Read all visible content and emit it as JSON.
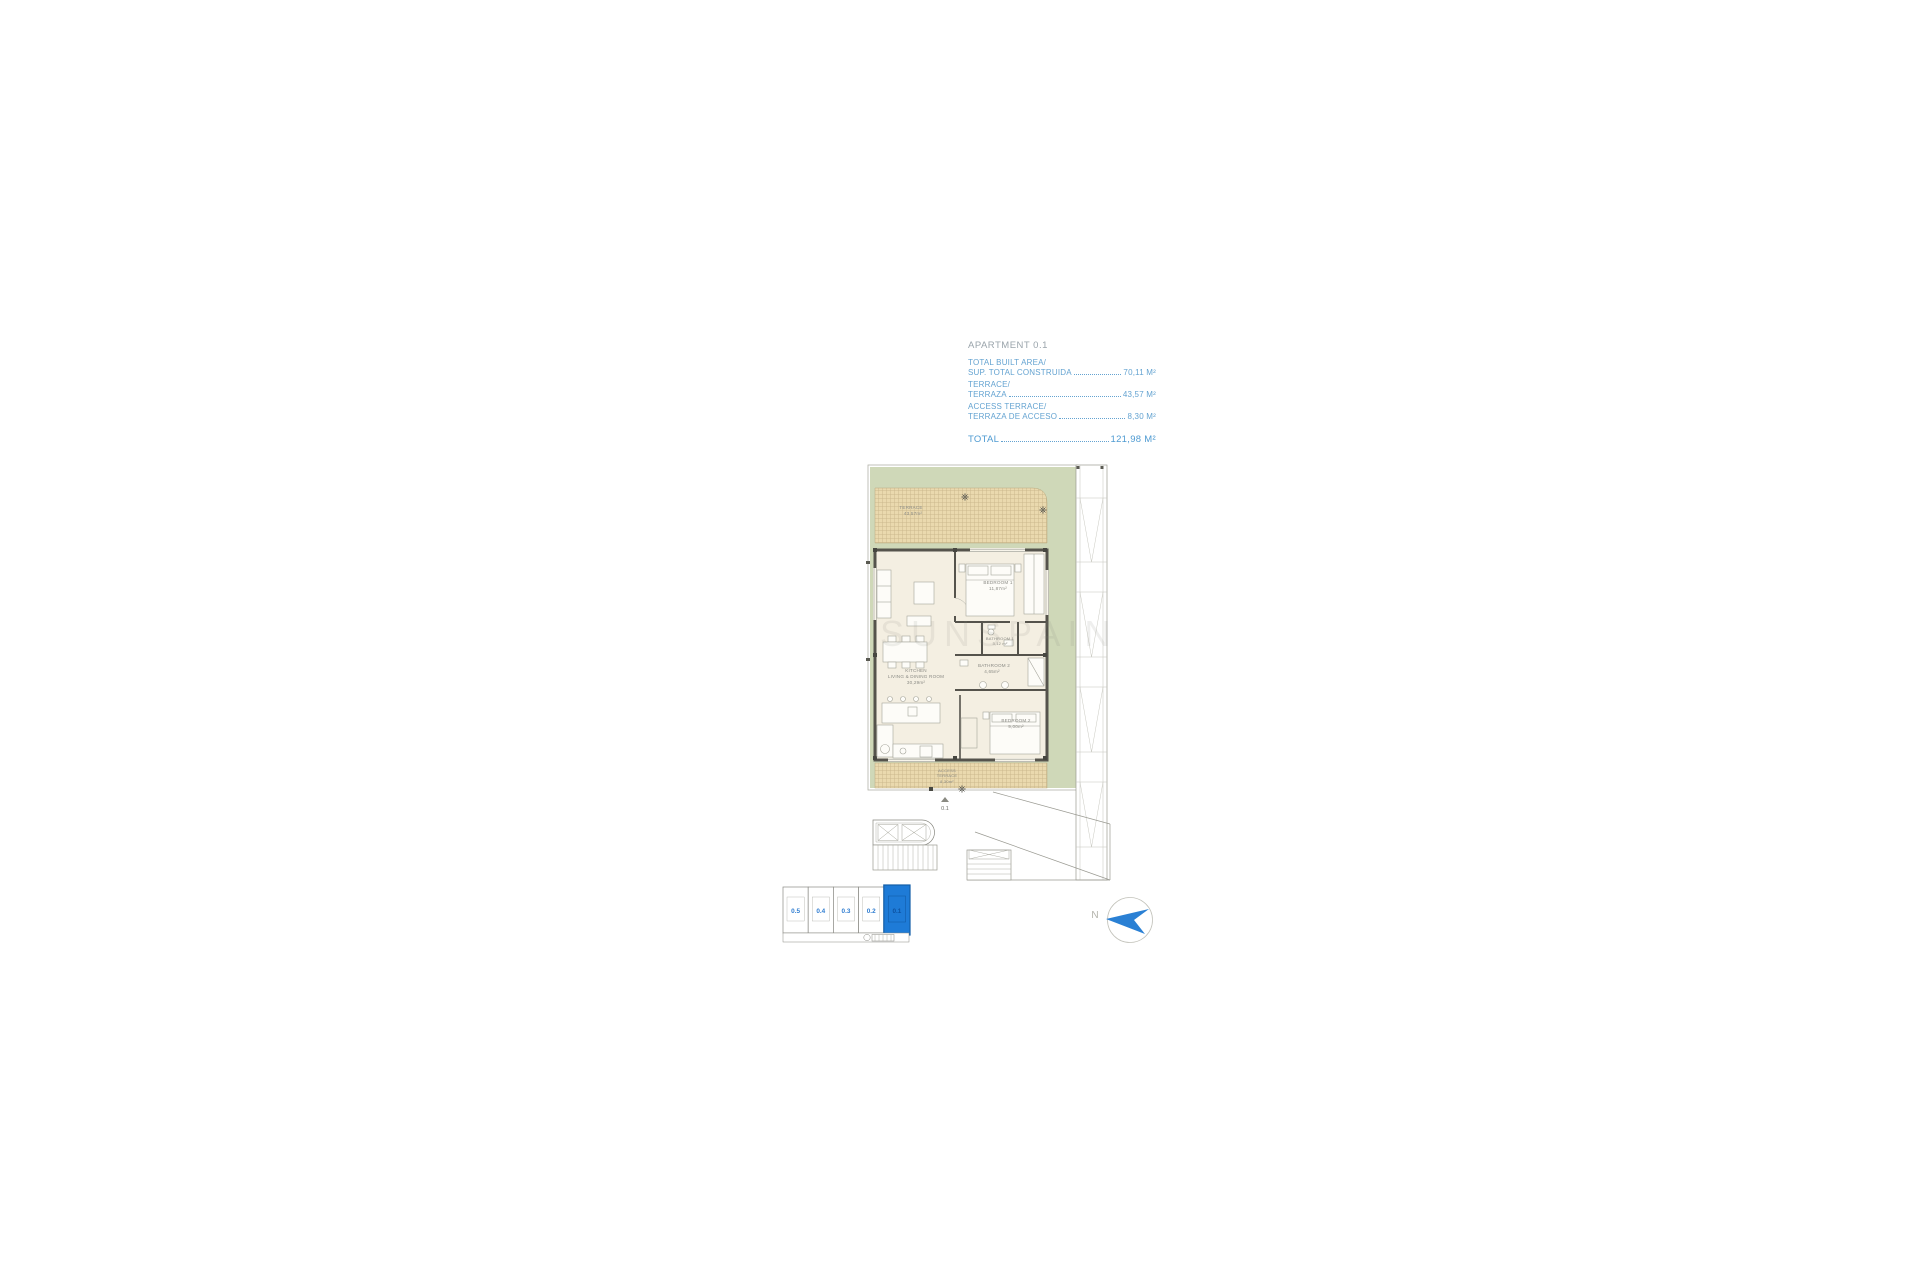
{
  "info": {
    "title": "APARTMENT 0.1",
    "rows": [
      {
        "label1": "TOTAL BUILT AREA/",
        "label2": "SUP. TOTAL CONSTRUIDA",
        "value": "70,11 M²"
      },
      {
        "label1": "TERRACE/",
        "label2": "TERRAZA",
        "value": "43,57 M²"
      },
      {
        "label1": "ACCESS TERRACE/",
        "label2": "TERRAZA DE ACCESO",
        "value": "8,30 M²"
      }
    ],
    "total_label": "TOTAL",
    "total_value": "121,98 M²"
  },
  "plan": {
    "terrace": {
      "name": "TERRACE",
      "area": "43,57m²"
    },
    "bedroom1": {
      "name": "BEDROOM 1",
      "area": "11,87m²"
    },
    "bathroom1": {
      "name": "BATHROOM 1",
      "area": "3,12 m²"
    },
    "bathroom2": {
      "name": "BATHROOM 2",
      "area": "4,65m²"
    },
    "bedroom2": {
      "name": "BEDROOM 2",
      "area": "9,00m²"
    },
    "kitchen": {
      "name1": "KITCHEN",
      "name2": "LIVING & DINING ROOM",
      "area": "30,29m²"
    },
    "access_terrace": {
      "name1": "ACCESS",
      "name2": "TERRACE",
      "area": "8,30m²"
    },
    "unit_marker": "0.1"
  },
  "locator": {
    "units": [
      "0.5",
      "0.4",
      "0.3",
      "0.2",
      "0.1"
    ],
    "highlighted_unit": "0.1"
  },
  "compass": {
    "north_label": "N"
  },
  "watermark": "SUNSPAIN",
  "colors": {
    "accent_blue": "#64a3d1",
    "unit_highlight": "#1e7bd7",
    "compass_blue": "#2a80d4",
    "site_green": "#cfd8b8",
    "terrace_tan": "#ead9ae"
  }
}
